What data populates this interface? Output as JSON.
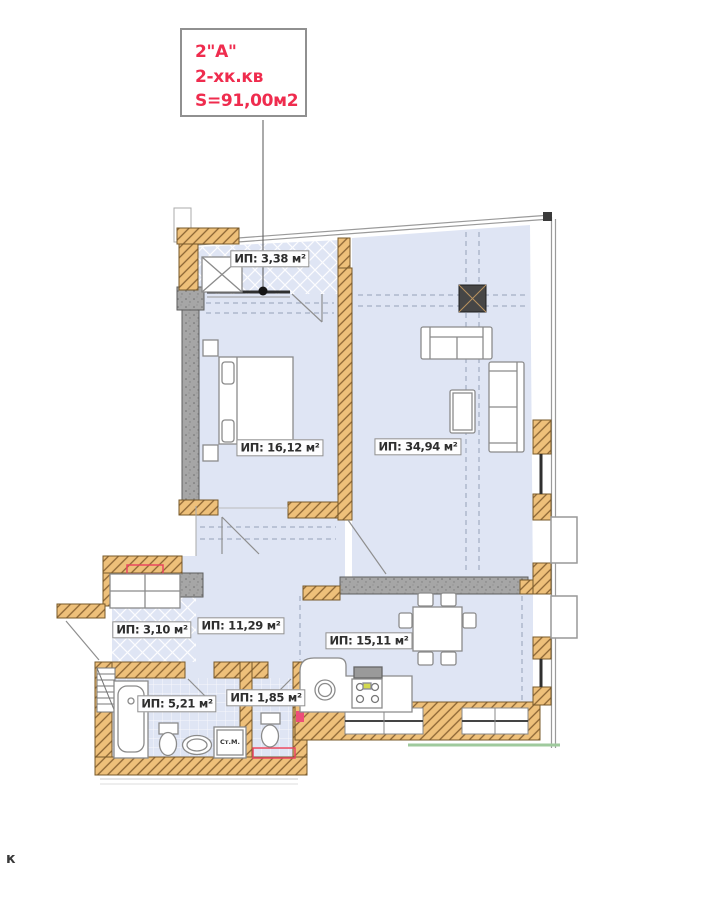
{
  "plan": {
    "title_box": {
      "lines": [
        "2\"A\"",
        "2-хк.кв",
        "S=91,00м2"
      ],
      "text_color": "#ef2c4e"
    },
    "rooms": [
      {
        "name": "balcony",
        "label": "ИП: 3,38 м²"
      },
      {
        "name": "bedroom",
        "label": "ИП: 16,12 м²"
      },
      {
        "name": "living-room",
        "label": "ИП: 34,94 м²"
      },
      {
        "name": "entry-hall",
        "label": "ИП: 3,10 м²"
      },
      {
        "name": "hall",
        "label": "ИП: 11,29 м²"
      },
      {
        "name": "kitchen-dining",
        "label": "ИП: 15,11 м²"
      },
      {
        "name": "bathroom",
        "label": "ИП: 5,21 м²"
      },
      {
        "name": "wc",
        "label": "ИП: 1,85 м²"
      }
    ],
    "annotations": {
      "washing_machine": "Ст.М.",
      "bottom_left_text": "к"
    },
    "colors": {
      "wall_brick": "#eec07a",
      "concrete": "#a6a6a6",
      "room_fill": "#dfe5f4",
      "accent_red": "#ef2c4e",
      "green_line": "#9fca9d"
    }
  }
}
